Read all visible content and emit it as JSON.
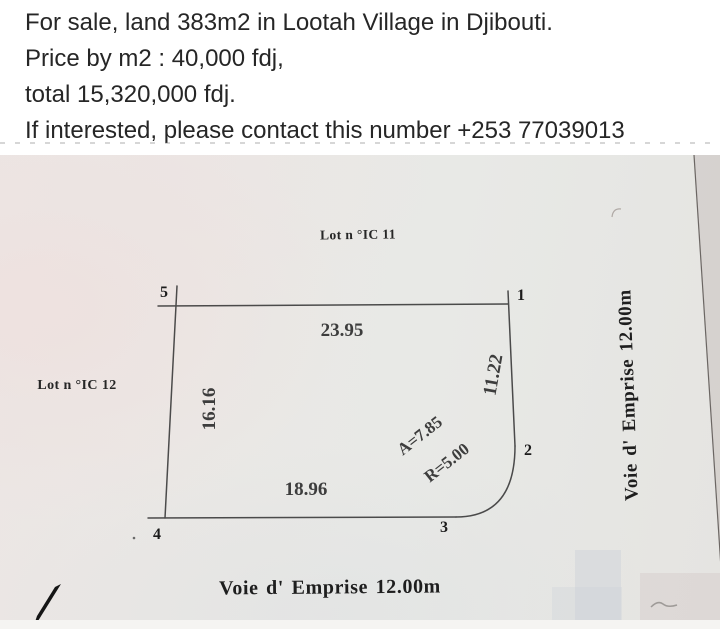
{
  "listing": {
    "line1": "For sale, land 383m2 in Lootah Village in Djibouti.",
    "line2": "Price by m2 : 40,000 fdj,",
    "line3": "total 15,320,000 fdj.",
    "line4": "If interested, please contact this number +253 77039013"
  },
  "plan": {
    "neighbor_top": "Lot n °IC 11",
    "neighbor_left": "Lot n °IC 12",
    "road_bottom": "Voie d' Emprise 12.00m",
    "road_right": "Voie d' Emprise 12.00m",
    "corners": {
      "c1": "1",
      "c2": "2",
      "c3": "3",
      "c4": "4",
      "c5": "5"
    },
    "dims": {
      "top": "23.95",
      "right": "11.22",
      "left": "16.16",
      "bottom": "18.96",
      "arc": "A=7.85",
      "radius": "R=5.00"
    }
  },
  "colors": {
    "page_bg": "#ffffff",
    "paper": "#e9e8e5",
    "ink": "#3a3a3a",
    "ad_text": "#262626"
  }
}
